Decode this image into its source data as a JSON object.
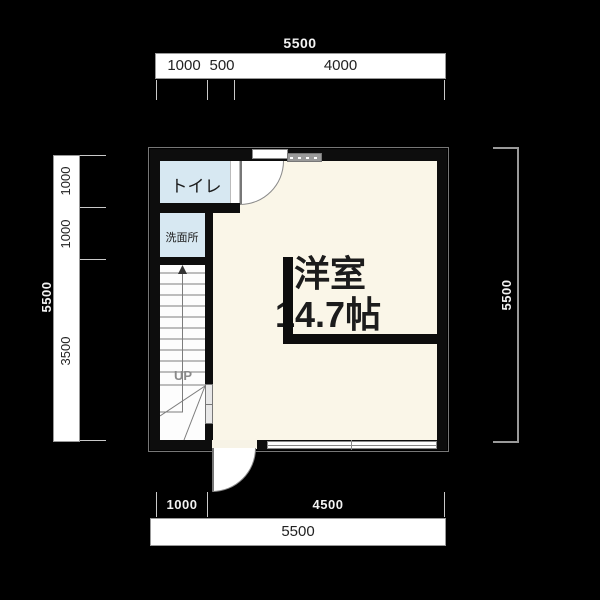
{
  "plan": {
    "rooms": {
      "toilet": "トイレ",
      "washroom": "洗面所",
      "main_room_name": "洋室",
      "main_room_size": "14.7帖",
      "stairs_label": "UP"
    },
    "dims": {
      "top": {
        "total": "5500",
        "seg": [
          "1000",
          "500",
          "4000"
        ]
      },
      "left": {
        "total": "5500",
        "seg": [
          "1000",
          "1000",
          "3500"
        ]
      },
      "right": {
        "total": "5500"
      },
      "bottom": {
        "total": "5500",
        "seg": [
          "1000",
          "4500"
        ]
      }
    },
    "colors": {
      "background": "#000000",
      "floor": "#faf6e8",
      "wet_rooms": "#d7e8f2",
      "walls": "#0d0d0d",
      "dimension_bar": "#ffffff"
    }
  }
}
